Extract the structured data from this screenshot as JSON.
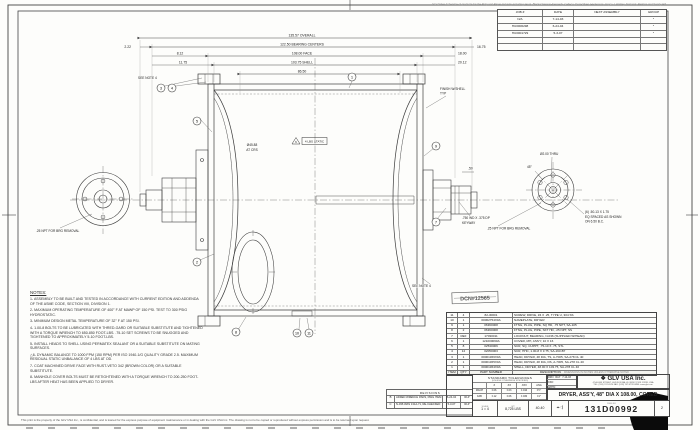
{
  "page": {
    "top_line": "GLV Sales & Service of products for the Pulp and Paper Industry including: Hunt, Black Clawson-Kennedy, Celleco, Dorr-Oliver, Hedemora, Impco, LaValley, National, Perkins and Sandy Hill",
    "disclaimer": "This print is the property of the GLV USA Inc., is confidential, and is loaned for the express purpose of equipment maintenance or in dealing with the GLV USA Inc.  The drawing is not to be copied or reproduced without express permission and is to be returned upon request."
  },
  "job_table": {
    "headers": [
      "JOB #",
      "DATE",
      "NEXT ASSEMBLY",
      "GROUP"
    ],
    "rows": [
      {
        "job": "N/A",
        "date": "7-14-03",
        "next": "",
        "group": "*"
      },
      {
        "job": "HU0006298",
        "date": "6-24-04",
        "next": "",
        "group": "*"
      },
      {
        "job": "HU0001729",
        "date": "5-3-07",
        "next": "",
        "group": "*"
      }
    ]
  },
  "notes": {
    "title": "NOTES:",
    "items": [
      "1-  ASSEMBLY TO BE BUILT AND TESTED IN ACCORDANCE WITH CURRENT EDITION AND ADDENDA OF THE ASME CODE, SECTION VIII, DIVISION 1.",
      "2-  MAXIMUM OPERATING TEMPERATURE OF 400° F AT MAWP OF 150 PSI. TEST TO 300 PSIG HYDROSTATIC.",
      "3-  MINIMUM DESIGN METAL TEMPERATURE OF 32° F AT 150 PSI.",
      "4-  1.00-8 BOLTS TO BE LUBRICATED WITH THRED-GARD OR SUITABLE SUBSTITUTE AND TIGHTENED WITH A TORQUE WRENCH TO 650-850 FOOT-LBS.  .75-10 SET SCREWS TO BE SNUGGED AND TIGHTENED TO APPROXIMATELY 5-10 FOOT-LBS.",
      "5-  INSTALL HEADS TO SHELL USING PERMATEX SEALANT OR A SUITABLE SUBSTITUTE ON MATING SURFACES.",
      "△6- DYNAMIC BALANCE TO 1000 FPM (150 RPM) PER ISO 1940-1/G QUALITY GRADE 2.5.  MAXIMUM RESIDUAL STATIC UNBALANCE OF 4 LBS AT OD.",
      "7-  COAT MACHINED DRIVE FACE WITH RUST-VETO 342 (BROWN COLOR) OR A SUITABLE SUBSTITUTE.",
      "8-  MANHOLE COVER BOLTS MUST BE RETIGHTENED WITH A TORQUE WRENCH TO 200-250 FOOT-LBS AFTER HEAT HAS BEEN APPLIED TO DRYER."
    ]
  },
  "bom": {
    "header": {
      "item": "ITEM",
      "qty": "QTY",
      "part": "PART NUMBER",
      "desc": "DESCRIPTION",
      "note": "DIMENSIONS IN INCHES UNLESS OTHERWISE NOTED"
    },
    "rows": [
      {
        "item": "11",
        "qty": "4",
        "part": "82-30001",
        "desc": "SCREW, DRIVE, #4 X .25, TYPE U, 304 SS"
      },
      {
        "item": "10",
        "qty": "1",
        "part": "00062754X0A",
        "desc": "NAMEPLATE, DRYER"
      },
      {
        "item": "9",
        "qty": "1",
        "part": "06360008",
        "desc": "FTNG, PLUG, PIPE, SQ HD, .75 NPT, SA-105"
      },
      {
        "item": "8",
        "qty": "2",
        "part": "06360008",
        "desc": "FTNG, PLUG, PIPE, SKT HD, .25 NPT, SS"
      },
      {
        "item": "7",
        "qty": "REF",
        "part": "17030011",
        "desc": "LOCKNUT, BEARING, N-036 (SUPPLIED W/HEAD)"
      },
      {
        "item": "6",
        "qty": "1",
        "part": "121000060A",
        "desc": "COVER, MH, ASS'Y, 10 X 16"
      },
      {
        "item": "5",
        "qty": "8",
        "part": "02530006",
        "desc": "SCR, SQ, CUPPT, .75-10 X .75, STL"
      },
      {
        "item": "4",
        "qty": "12",
        "part": "02050003",
        "desc": "SCR, HHC, 1.00-8 X 3.75, SA-193-B7"
      },
      {
        "item": "3",
        "qty": "1",
        "part": "00001366X0A",
        "desc": "HEAD, DRYER, 48 DIA, TS, A-7005, SA-278 CL 40"
      },
      {
        "item": "2",
        "qty": "1",
        "part": "00001365X0A",
        "desc": "HEAD, DRYER, 48 DIA, DS, A-7005, SA-278 CL 40"
      },
      {
        "item": "1",
        "qty": "1",
        "part": "00001364X0A",
        "desc": "SHELL, DRYER, 48.00 X 103.75, SA-278 CL 40"
      }
    ]
  },
  "revisions": {
    "title": "REVISIONS",
    "rows": [
      {
        "ltr": "B",
        "desc": "ADDED WRENCH PADS, DWG ITEM 13 WAS 11",
        "date": "6-24-04",
        "by": "RLP"
      },
      {
        "ltr": "C",
        "desc": "N-036 WAS 131A-71, RE-CHECKED",
        "date": "5-3-07",
        "by": "RLP"
      }
    ]
  },
  "title_block": {
    "logo": "❖",
    "company": "GLV USA Inc.",
    "address1": "47 ALLEN STREET, HUDSON FALLS, NEW YORK 12839, USA",
    "address2": "TEL: (518) 747-0524   FAX: (518) 747-0793   WEB: www.glv.com",
    "title": "DRYER, ASS'Y, 48\" DIA X 108.00, CORED",
    "drn_label": "DRN",
    "drn_val": "RLP",
    "drn_date": "7-14-03",
    "ckd_label": "CKD",
    "appd_label": "APP'D",
    "scale_label": "SCALE",
    "scale_val": "1 = 4",
    "wt_label": "WT",
    "weight": "8,725 LBS",
    "code": "40-40",
    "proj_icon": "⌖◁",
    "dwg_label": "DWG NO",
    "dwg_no": "131D00992",
    "rev": "2",
    "tolerances": {
      "title": "STANDARD TOLERANCES",
      "sub": "(UNLESS OTHERWISE SPECIFIED)",
      "cols": [
        "",
        ".X",
        ".XX",
        ".XXX",
        "ANG"
      ],
      "row1": [
        "MACH",
        "±.06",
        "±.03",
        "±.010",
        "±½°"
      ],
      "row2": [
        "FAB",
        "±.12",
        "±.06",
        "±.030",
        "±1°"
      ]
    }
  },
  "drawing": {
    "dims": {
      "overall": "135.57 OVERALL",
      "bearing_centers": "122.50 BEARING CENTERS",
      "face": "108.00 FACE",
      "shell": "103.75 SHELL",
      "cored": "86.50",
      "left1": "2.22",
      "left2": "8.12",
      "left3": "11.75",
      "right1": "16.75",
      "right2": "18.00",
      "right3": "20.12",
      "shaft": ".50"
    },
    "labels": {
      "see_note_4": "SEE NOTE 4",
      "see_note_4b": "SEE NOTE 4",
      "finish1": "FINISH W/SHELL",
      "finish2": "TYP",
      "dia1": "Ø45.88",
      "dia2": "AT CRS",
      "static_flag": "6",
      "static_box": "4 LBS STATIC",
      "keyway1": ".750 WD X .375 DP",
      "keyway2": "KEYWAY",
      "thru": "Ø2.00 THRU",
      "bolts1": "(6) .50-13 X 1.75",
      "bolts2": "EQ SPACED AS SHOWN",
      "bolts3": "ON 6.50 B.C.",
      "angle": "45°",
      "brg_left": ".25 NPT FOR BRG REMOVAL",
      "brg_right": ".25 NPT FOR BRG REMOVAL",
      "stamp": "DCN#12565"
    },
    "balloons": {
      "b1": "1",
      "b2": "2",
      "b3": "3",
      "b4": "4",
      "b5": "5",
      "b7": "7",
      "b8": "8",
      "b9": "9",
      "b10": "10",
      "b11": "11"
    }
  }
}
